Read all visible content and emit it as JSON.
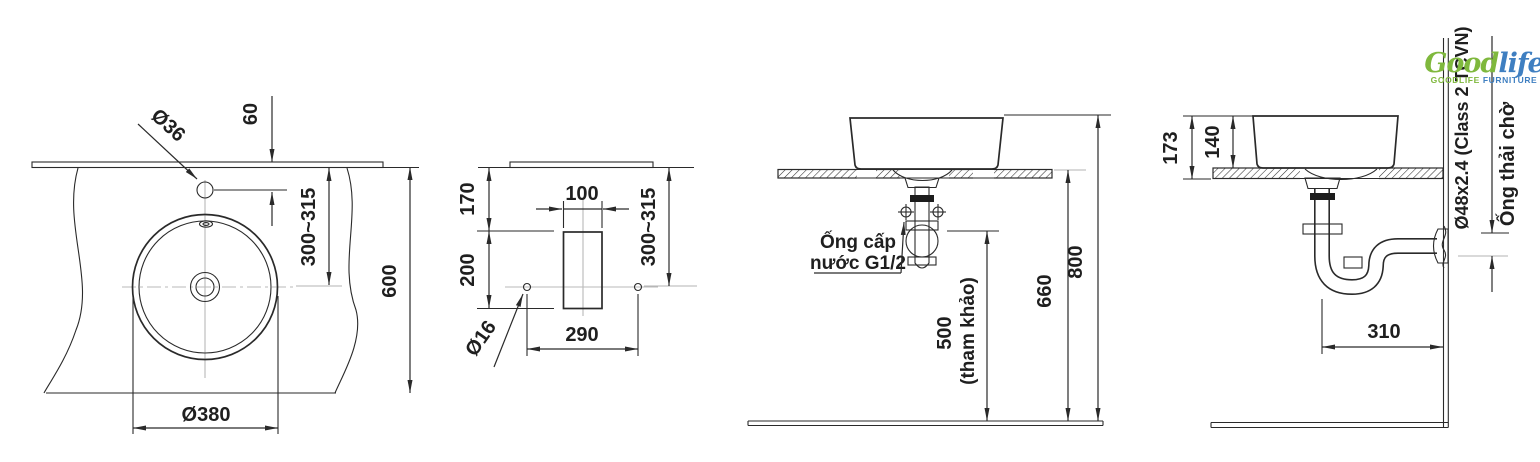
{
  "logo": {
    "brand_part1": "Good",
    "brand_part2": "life",
    "tagline_part1": "GOODLIFE",
    "tagline_part2": " FURNITURE",
    "green": "#7fb83d",
    "blue": "#3f7fc1"
  },
  "colors": {
    "line": "#2a2a2a",
    "muted": "#b3b3b3",
    "text": "#1f1f1f"
  },
  "views": {
    "plan": {
      "faucet_hole_dia": "Ø36",
      "edge_to_faucet": "60",
      "edge_to_center": "300~315",
      "counter_depth": "600",
      "basin_dia": "Ø380"
    },
    "cutout": {
      "edge_to_cutout": "170",
      "cutout_to_holes": "200",
      "cutout_width": "100",
      "holes_spacing": "290",
      "hole_dia": "Ø16",
      "edge_to_holes": "300~315"
    },
    "front": {
      "supply_label_line1": "Ống cấp",
      "supply_label_line2": "nước G1/2",
      "supply_height": "500",
      "supply_height_note": "(tham khảo)",
      "counter_height": "660",
      "rim_height": "800"
    },
    "side": {
      "rim_to_counter_bottom": "173",
      "basin_height": "140",
      "trap_to_wall": "310",
      "waste_pipe_spec": "Ø48x2.4 (Class 2 TCVN)",
      "waste_pipe_label": "Ống thải chờ"
    }
  }
}
